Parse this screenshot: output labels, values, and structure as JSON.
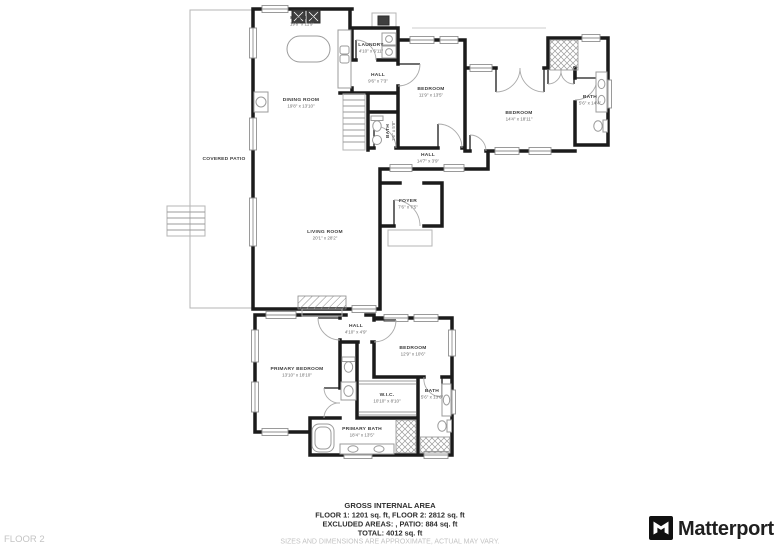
{
  "plan": {
    "floor_label": "FLOOR 2",
    "brand": "Matterport",
    "colors": {
      "wall": "#1b1b1b",
      "window": "#8f8f8f",
      "text": "#3c3c3c",
      "muted": "#c3c3c3"
    },
    "rooms": [
      {
        "id": "kitchen",
        "name": "KITCHEN",
        "dims": "19'8\" x 11'9\""
      },
      {
        "id": "dining-room",
        "name": "DINING ROOM",
        "dims": "19'8\" x 13'10\""
      },
      {
        "id": "covered-patio",
        "name": "COVERED PATIO",
        "dims": ""
      },
      {
        "id": "laundry",
        "name": "LAUNDRY",
        "dims": "4'10\" x 6'11\""
      },
      {
        "id": "hall-upper",
        "name": "HALL",
        "dims": "9'6\" x 7'3\""
      },
      {
        "id": "bedroom-2",
        "name": "BEDROOM",
        "dims": "11'9\" x 13'5\""
      },
      {
        "id": "bedroom-3",
        "name": "BEDROOM",
        "dims": "14'4\" x 18'11\""
      },
      {
        "id": "bath-2",
        "name": "BATH",
        "dims": "5'6\" x 14'4\""
      },
      {
        "id": "hall-middle",
        "name": "HALL",
        "dims": "14'7\" x 3'9\""
      },
      {
        "id": "foyer",
        "name": "FOYER",
        "dims": "7'6\" x 7'5\""
      },
      {
        "id": "living-room",
        "name": "LIVING ROOM",
        "dims": "20'1\" x 28'2\""
      },
      {
        "id": "bath-powder",
        "name": "BATH",
        "dims": "3'6\" x 5'8\""
      },
      {
        "id": "hall-lower",
        "name": "HALL",
        "dims": "4'10\" x 4'9\""
      },
      {
        "id": "primary-bedroom",
        "name": "PRIMARY BEDROOM",
        "dims": "13'10\" x 18'10\""
      },
      {
        "id": "bedroom-4",
        "name": "BEDROOM",
        "dims": "12'9\" x 10'6\""
      },
      {
        "id": "wic",
        "name": "W.I.C.",
        "dims": "10'10\" x 8'10\""
      },
      {
        "id": "bath-3",
        "name": "BATH",
        "dims": "5'6\" x 13'6\""
      },
      {
        "id": "primary-bath",
        "name": "PRIMARY BATH",
        "dims": "18'4\" x 13'5\""
      }
    ],
    "footer": {
      "title": "GROSS INTERNAL AREA",
      "line1": "FLOOR 1: 1201 sq. ft, FLOOR 2: 2812 sq. ft",
      "line2": "EXCLUDED AREAS: , PATIO: 884 sq. ft",
      "line3": "TOTAL: 4012 sq. ft",
      "disclaimer": "SIZES AND DIMENSIONS ARE APPROXIMATE, ACTUAL MAY VARY."
    }
  }
}
